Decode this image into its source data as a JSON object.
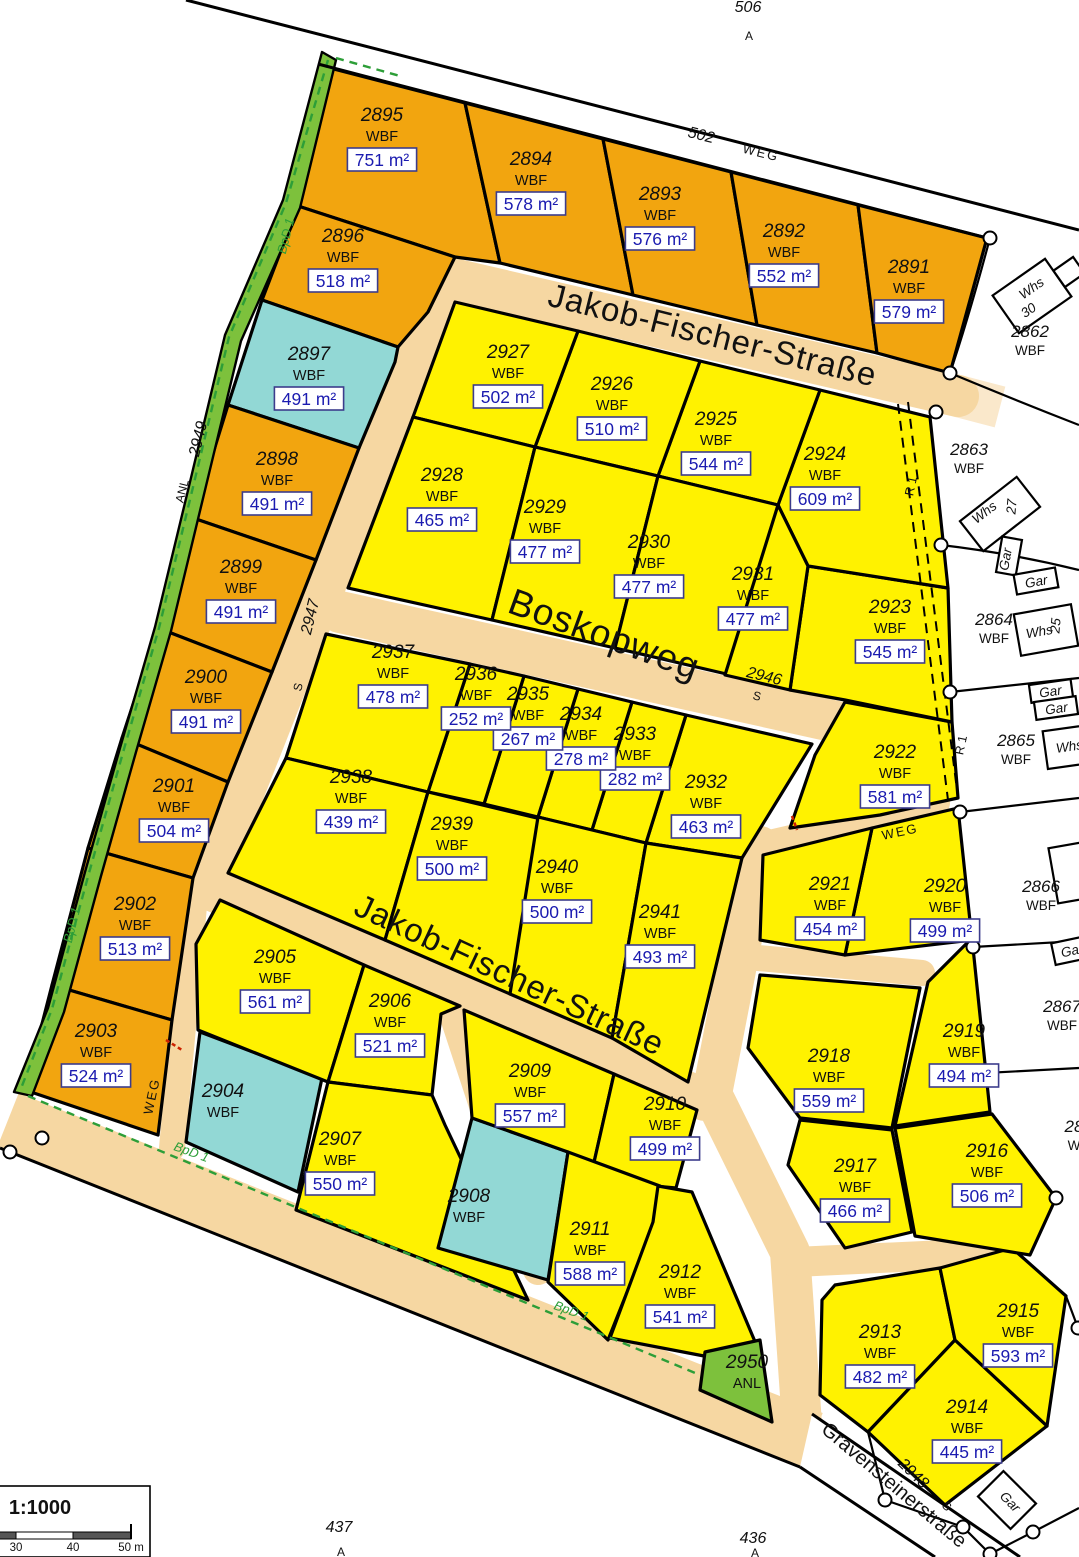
{
  "map": {
    "title": "Bebauungsplan parcel map",
    "colors": {
      "orange_parcel": "#F2A50F",
      "yellow_parcel": "#FFF200",
      "cyan_parcel": "#92D8D5",
      "green_area": "#7DC13C",
      "street_fill": "#F6D7A2",
      "area_text_blue": "#1b1bb0"
    },
    "streets": {
      "jakob_fischer": "Jakob-Fischer-Straße",
      "boskopweg": "Boskopweg",
      "gravensteinerstrasse": "Gravensteinerstraße"
    },
    "labels": {
      "n506": "506",
      "n502": "502",
      "weg": "WEG",
      "a": "A",
      "n2947": "2947",
      "s": "S",
      "n2949": "2949",
      "anl": "ANL",
      "n2946": "2946",
      "n2948": "2948",
      "bpd1": "BpD 1",
      "r1": "R 1",
      "n437": "437",
      "n436": "436",
      "whs": "Whs",
      "n30": "30",
      "n27": "27",
      "n25": "25",
      "gar": "Gar"
    },
    "scale": {
      "ratio": "1:1000",
      "tick30": "30",
      "tick40": "40",
      "tick50": "50 m"
    }
  },
  "parcels": [
    {
      "num": "2895",
      "type": "WBF",
      "area": "751 m²",
      "x": 382,
      "y": 121,
      "cls": "std"
    },
    {
      "num": "2894",
      "type": "WBF",
      "area": "578 m²",
      "x": 531,
      "y": 165,
      "cls": "std"
    },
    {
      "num": "2893",
      "type": "WBF",
      "area": "576 m²",
      "x": 660,
      "y": 200,
      "cls": "std"
    },
    {
      "num": "2892",
      "type": "WBF",
      "area": "552 m²",
      "x": 784,
      "y": 237,
      "cls": "std"
    },
    {
      "num": "2891",
      "type": "WBF",
      "area": "579 m²",
      "x": 909,
      "y": 273,
      "cls": "std"
    },
    {
      "num": "2896",
      "type": "WBF",
      "area": "518 m²",
      "x": 343,
      "y": 242,
      "cls": "std"
    },
    {
      "num": "2897",
      "type": "WBF",
      "area": "491 m²",
      "x": 309,
      "y": 360,
      "cls": "std"
    },
    {
      "num": "2898",
      "type": "WBF",
      "area": "491 m²",
      "x": 277,
      "y": 465,
      "cls": "std"
    },
    {
      "num": "2899",
      "type": "WBF",
      "area": "491 m²",
      "x": 241,
      "y": 573,
      "cls": "std"
    },
    {
      "num": "2900",
      "type": "WBF",
      "area": "491 m²",
      "x": 206,
      "y": 683,
      "cls": "std"
    },
    {
      "num": "2901",
      "type": "WBF",
      "area": "504 m²",
      "x": 174,
      "y": 792,
      "cls": "std"
    },
    {
      "num": "2902",
      "type": "WBF",
      "area": "513 m²",
      "x": 135,
      "y": 910,
      "cls": "std"
    },
    {
      "num": "2903",
      "type": "WBF",
      "area": "524 m²",
      "x": 96,
      "y": 1037,
      "cls": "std"
    },
    {
      "num": "2904",
      "type": "WBF",
      "x": 223,
      "y": 1097,
      "cls": "std"
    },
    {
      "num": "2905",
      "type": "WBF",
      "area": "561 m²",
      "x": 275,
      "y": 963,
      "cls": "std"
    },
    {
      "num": "2906",
      "type": "WBF",
      "area": "521 m²",
      "x": 390,
      "y": 1007,
      "cls": "std"
    },
    {
      "num": "2907",
      "type": "WBF",
      "area": "550 m²",
      "x": 340,
      "y": 1145,
      "cls": "std"
    },
    {
      "num": "2908",
      "type": "WBF",
      "x": 469,
      "y": 1202,
      "cls": "std"
    },
    {
      "num": "2909",
      "type": "WBF",
      "area": "557 m²",
      "x": 530,
      "y": 1077,
      "cls": "std"
    },
    {
      "num": "2910",
      "type": "WBF",
      "area": "499 m²",
      "x": 665,
      "y": 1110,
      "cls": "std"
    },
    {
      "num": "2911",
      "type": "WBF",
      "area": "588 m²",
      "x": 590,
      "y": 1235,
      "cls": "std"
    },
    {
      "num": "2912",
      "type": "WBF",
      "area": "541 m²",
      "x": 680,
      "y": 1278,
      "cls": "std"
    },
    {
      "num": "2913",
      "type": "WBF",
      "area": "482 m²",
      "x": 880,
      "y": 1338,
      "cls": "std"
    },
    {
      "num": "2914",
      "type": "WBF",
      "area": "445 m²",
      "x": 967,
      "y": 1413,
      "cls": "std"
    },
    {
      "num": "2915",
      "type": "WBF",
      "area": "593 m²",
      "x": 1018,
      "y": 1317,
      "cls": "std"
    },
    {
      "num": "2916",
      "type": "WBF",
      "area": "506 m²",
      "x": 987,
      "y": 1157,
      "cls": "std"
    },
    {
      "num": "2917",
      "type": "WBF",
      "area": "466 m²",
      "x": 855,
      "y": 1172,
      "cls": "std"
    },
    {
      "num": "2918",
      "type": "WBF",
      "area": "559 m²",
      "x": 829,
      "y": 1062,
      "cls": "std"
    },
    {
      "num": "2919",
      "type": "WBF",
      "area": "494 m²",
      "x": 964,
      "y": 1037,
      "cls": "std"
    },
    {
      "num": "2920",
      "type": "WBF",
      "area": "499 m²",
      "x": 945,
      "y": 892,
      "cls": "std"
    },
    {
      "num": "2921",
      "type": "WBF",
      "area": "454 m²",
      "x": 830,
      "y": 890,
      "cls": "std"
    },
    {
      "num": "2922",
      "type": "WBF",
      "area": "581 m²",
      "x": 895,
      "y": 758,
      "cls": "std"
    },
    {
      "num": "2923",
      "type": "WBF",
      "area": "545 m²",
      "x": 890,
      "y": 613,
      "cls": "std"
    },
    {
      "num": "2924",
      "type": "WBF",
      "area": "609 m²",
      "x": 825,
      "y": 460,
      "cls": "std"
    },
    {
      "num": "2925",
      "type": "WBF",
      "area": "544 m²",
      "x": 716,
      "y": 425,
      "cls": "std"
    },
    {
      "num": "2926",
      "type": "WBF",
      "area": "510 m²",
      "x": 612,
      "y": 390,
      "cls": "std"
    },
    {
      "num": "2927",
      "type": "WBF",
      "area": "502 m²",
      "x": 508,
      "y": 358,
      "cls": "std"
    },
    {
      "num": "2928",
      "type": "WBF",
      "area": "465 m²",
      "x": 442,
      "y": 481,
      "cls": "std"
    },
    {
      "num": "2929",
      "type": "WBF",
      "area": "477 m²",
      "x": 545,
      "y": 513,
      "cls": "std"
    },
    {
      "num": "2930",
      "type": "WBF",
      "area": "477 m²",
      "x": 649,
      "y": 548,
      "cls": "std"
    },
    {
      "num": "2931",
      "type": "WBF",
      "area": "477 m²",
      "x": 753,
      "y": 580,
      "cls": "std"
    },
    {
      "num": "2932",
      "type": "WBF",
      "area": "463 m²",
      "x": 706,
      "y": 788,
      "cls": "std"
    },
    {
      "num": "2933",
      "type": "WBF",
      "area": "282 m²",
      "x": 635,
      "y": 740,
      "cls": "std"
    },
    {
      "num": "2934",
      "type": "WBF",
      "area": "278 m²",
      "x": 581,
      "y": 720,
      "cls": "std"
    },
    {
      "num": "2935",
      "type": "WBF",
      "area": "267 m²",
      "x": 528,
      "y": 700,
      "cls": "std"
    },
    {
      "num": "2936",
      "type": "WBF",
      "area": "252 m²",
      "x": 476,
      "y": 680,
      "cls": "std"
    },
    {
      "num": "2937",
      "type": "WBF",
      "area": "478 m²",
      "x": 393,
      "y": 658,
      "cls": "std"
    },
    {
      "num": "2938",
      "type": "WBF",
      "area": "439 m²",
      "x": 351,
      "y": 783,
      "cls": "std"
    },
    {
      "num": "2939",
      "type": "WBF",
      "area": "500 m²",
      "x": 452,
      "y": 830,
      "cls": "std"
    },
    {
      "num": "2940",
      "type": "WBF",
      "area": "500 m²",
      "x": 557,
      "y": 873,
      "cls": "std"
    },
    {
      "num": "2941",
      "type": "WBF",
      "area": "493 m²",
      "x": 660,
      "y": 918,
      "cls": "std"
    },
    {
      "num": "2950",
      "type": "ANL",
      "x": 747,
      "y": 1368,
      "cls": "std"
    },
    {
      "num": "2862",
      "type": "WBF",
      "x": 1030,
      "y": 337,
      "cls": "white"
    },
    {
      "num": "2863",
      "type": "WBF",
      "x": 969,
      "y": 455,
      "cls": "white"
    },
    {
      "num": "2864",
      "type": "WBF",
      "x": 994,
      "y": 625,
      "cls": "white"
    },
    {
      "num": "2865",
      "type": "WBF",
      "x": 1016,
      "y": 746,
      "cls": "white"
    },
    {
      "num": "2866",
      "type": "WBF",
      "x": 1041,
      "y": 892,
      "cls": "white"
    },
    {
      "num": "2867",
      "type": "WBF",
      "x": 1062,
      "y": 1012,
      "cls": "white"
    },
    {
      "num": "28",
      "type": "W",
      "x": 1074,
      "y": 1132,
      "cls": "white"
    }
  ]
}
